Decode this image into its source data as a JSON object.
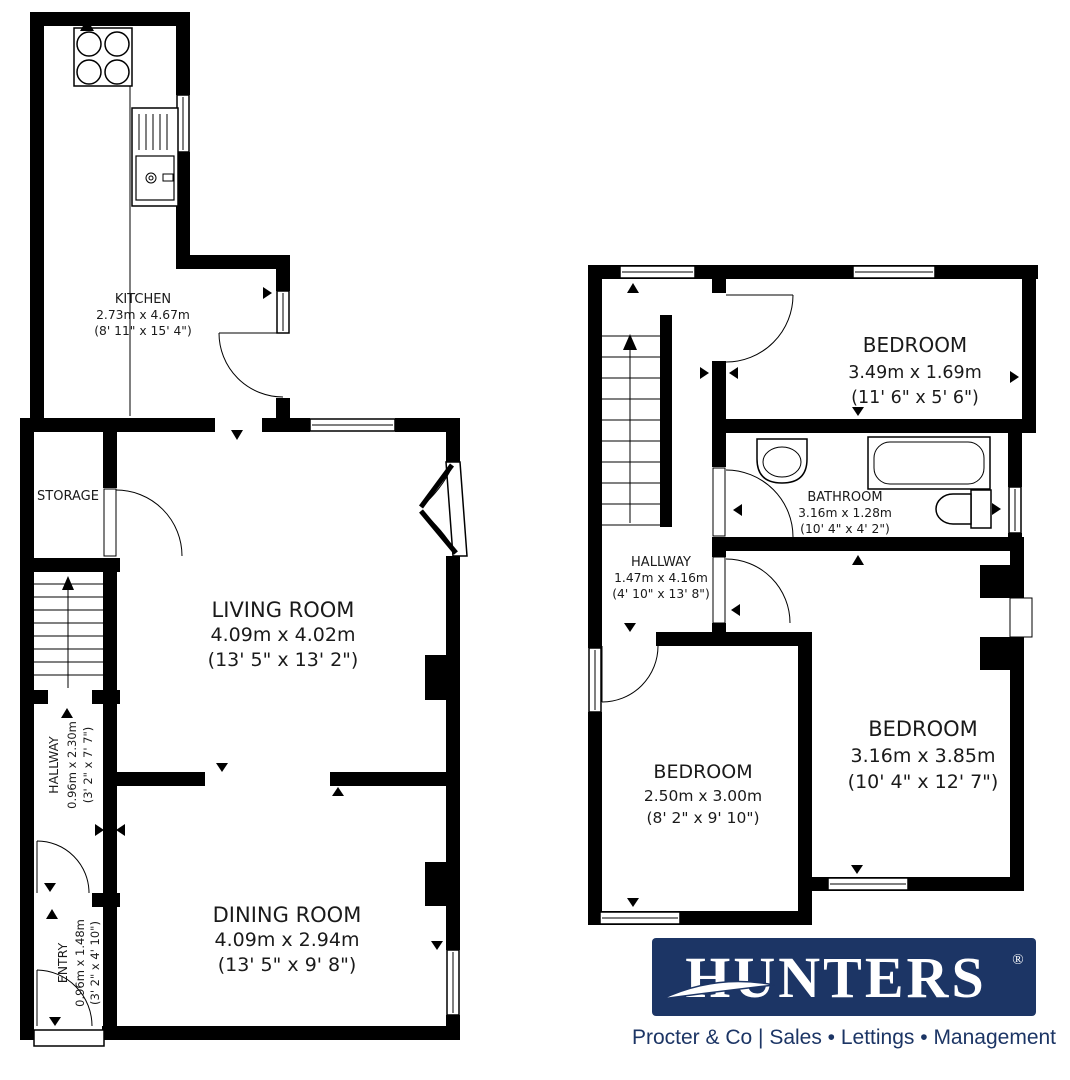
{
  "floors": {
    "ground": {
      "kitchen": {
        "name": "KITCHEN",
        "metric": "2.73m x 4.67m",
        "imperial": "(8' 11\" x 15' 4\")"
      },
      "storage": {
        "name": "STORAGE"
      },
      "living_room": {
        "name": "LIVING ROOM",
        "metric": "4.09m x 4.02m",
        "imperial": "(13' 5\" x 13' 2\")"
      },
      "hallway": {
        "name": "HALLWAY",
        "metric": "0.96m x 2.30m",
        "imperial": "(3' 2\" x 7' 7\")"
      },
      "entry": {
        "name": "ENTRY",
        "metric": "0.96m x 1.48m",
        "imperial": "(3' 2\" x 4' 10\")"
      },
      "dining_room": {
        "name": "DINING ROOM",
        "metric": "4.09m x 2.94m",
        "imperial": "(13' 5\" x 9' 8\")"
      }
    },
    "first": {
      "bedroom_front": {
        "name": "BEDROOM",
        "metric": "3.49m x 1.69m",
        "imperial": "(11' 6\" x 5' 6\")"
      },
      "bathroom": {
        "name": "BATHROOM",
        "metric": "3.16m x 1.28m",
        "imperial": "(10' 4\" x 4' 2\")"
      },
      "hallway": {
        "name": "HALLWAY",
        "metric": "1.47m x 4.16m",
        "imperial": "(4' 10\" x 13' 8\")"
      },
      "bedroom_middle": {
        "name": "BEDROOM",
        "metric": "2.50m x 3.00m",
        "imperial": "(8' 2\" x 9' 10\")"
      },
      "bedroom_rear": {
        "name": "BEDROOM",
        "metric": "3.16m x 3.85m",
        "imperial": "(10' 4\" x 12' 7\")"
      }
    }
  },
  "branding": {
    "logo_text": "HUNTERS",
    "registered_mark": "®",
    "tagline": "Procter & Co  |  Sales • Lettings • Management",
    "navy": "#1c3565"
  }
}
